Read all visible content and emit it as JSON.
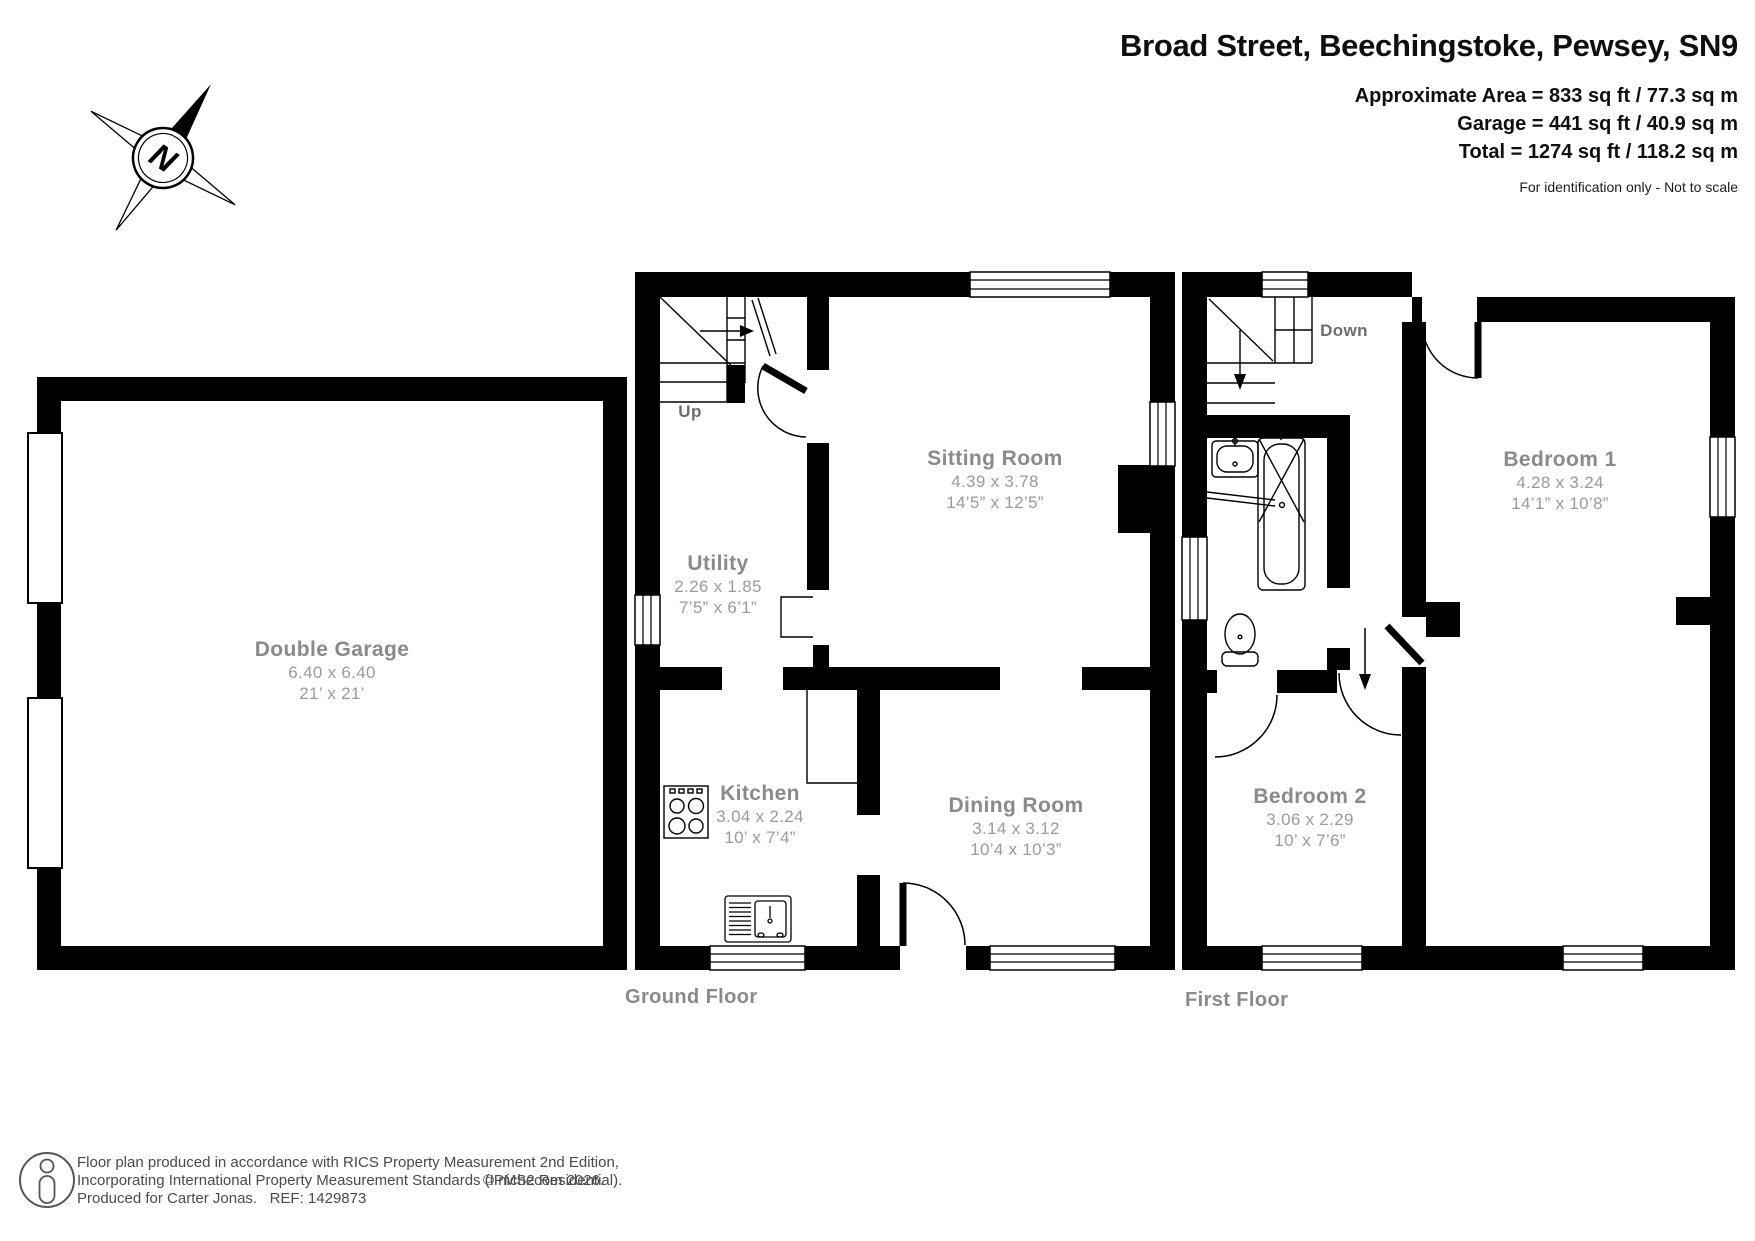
{
  "header": {
    "title": "Broad Street, Beechingstoke, Pewsey, SN9",
    "area_line_1": "Approximate Area = 833 sq ft / 77.3 sq m",
    "area_line_2": "Garage = 441 sq ft / 40.9 sq m",
    "area_line_3": "Total = 1274 sq ft / 118.2 sq m",
    "disclaimer": "For identification only - Not to scale"
  },
  "compass": {
    "north": "N"
  },
  "garage": {
    "name": "Double Garage",
    "metric": "6.40 x 6.40",
    "imperial": "21’ x 21’"
  },
  "ground_floor": {
    "label": "Ground Floor",
    "stairs": "Up",
    "rooms": {
      "sitting": {
        "name": "Sitting Room",
        "metric": "4.39 x 3.78",
        "imperial": "14’5” x 12’5”"
      },
      "utility": {
        "name": "Utility",
        "metric": "2.26 x 1.85",
        "imperial": "7’5” x 6’1”"
      },
      "kitchen": {
        "name": "Kitchen",
        "metric": "3.04 x 2.24",
        "imperial": "10’ x 7’4”"
      },
      "dining": {
        "name": "Dining Room",
        "metric": "3.14 x 3.12",
        "imperial": "10’4 x 10’3”"
      }
    }
  },
  "first_floor": {
    "label": "First Floor",
    "stairs": "Down",
    "rooms": {
      "bedroom1": {
        "name": "Bedroom 1",
        "metric": "4.28 x 3.24",
        "imperial": "14’1” x 10’8”"
      },
      "bedroom2": {
        "name": "Bedroom 2",
        "metric": "3.06 x 2.29",
        "imperial": "10’ x 7’6”"
      }
    }
  },
  "footer": {
    "line1": "Floor plan produced in accordance with RICS Property Measurement 2nd Edition,",
    "line2": "Incorporating International Property Measurement Standards (IPMS2 Residential).",
    "line3": "Produced for Carter Jonas.   REF: 1429873",
    "copyright": "© nichecom 2026."
  }
}
